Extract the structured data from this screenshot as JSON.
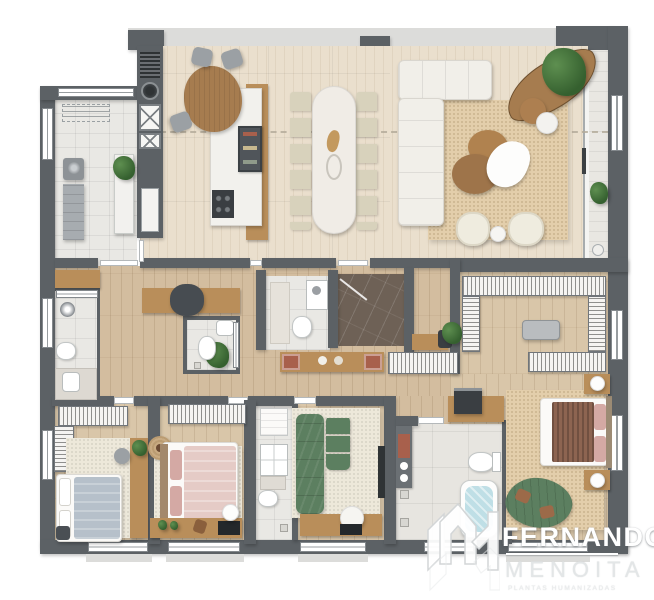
{
  "page": {
    "type": "residential floor plan — humanized top-view render",
    "background": "#ffffff"
  },
  "brand": {
    "line1": "FERNANDO",
    "line2": "MENOITA",
    "tagline": "PLANTAS HUMANIZADAS",
    "monogram": "FM-chevron-monogram"
  },
  "colors": {
    "wall": "#5c6165",
    "slab": "#dcdcda",
    "socialFloor": "#eadfcd",
    "serviceFloor": "#eae6dc",
    "hallFloor": "#d3bd9f",
    "bedroomFloor": "#d9c6a9",
    "tile": "#e9e8e4",
    "tileBig": "#e7e5e0",
    "marbleDark": "#6e6156",
    "marbleWhite": "#f2f1ed",
    "balconyFloor": "#e9e7e2",
    "rugBeige": "#e3ceab",
    "rugCream": "#ede8da",
    "woodFurn": "#b98e5a",
    "sofaWhite": "#f1efe9",
    "sofaGreen": "#5c7f60",
    "chaiseBrown": "#a67c4f",
    "bedGray": "#b6c0ca",
    "bedPink": "#e5cbc6",
    "duvetBrown": "#8d6451",
    "pillowPink": "#d4a9a4",
    "tub": "#bfdfe6",
    "terracotta": "#a8604c",
    "plantGreen": "#35602f",
    "darkAppliance": "#3a3e42",
    "logoWhite": "#ffffff",
    "logoLight": "#e3e6e7"
  },
  "rooms": [
    {
      "id": "service-laundry",
      "furniture": [
        "drying-rack",
        "washing-machine",
        "tall-appliance",
        "plant-console"
      ]
    },
    {
      "id": "elevator-core",
      "furniture": [
        "louver-vent",
        "gauge",
        "elevator-1",
        "elevator-2",
        "tall-cabinet"
      ]
    },
    {
      "id": "kitchen",
      "furniture": [
        "breakfast-table",
        "three-chairs",
        "marble-island",
        "wood-bar",
        "cooktop",
        "dark-shelf"
      ]
    },
    {
      "id": "dining-room",
      "furniture": [
        "long-table",
        "twelve-chairs",
        "centerpiece"
      ]
    },
    {
      "id": "living-room",
      "furniture": [
        "l-sofa",
        "curved-brown-chaise",
        "plant",
        "round-coffee-tables",
        "white-throw",
        "two-armchairs",
        "side-table",
        "beige-rug"
      ]
    },
    {
      "id": "balcony",
      "furniture": [
        "plants",
        "glass-door"
      ]
    },
    {
      "id": "guest-bathroom",
      "furniture": [
        "shower",
        "toilet",
        "vanity",
        "overhead-cabinet"
      ]
    },
    {
      "id": "home-office-nook",
      "furniture": [
        "desk",
        "chair",
        "floor-plant"
      ]
    },
    {
      "id": "powder-room",
      "furniture": [
        "toilet",
        "sink",
        "towel-rail"
      ]
    },
    {
      "id": "hall-bathroom",
      "furniture": [
        "counter",
        "toilet",
        "shower"
      ]
    },
    {
      "id": "private-elevator-hall",
      "furniture": [
        "dark-marble-floor",
        "entry-door"
      ]
    },
    {
      "id": "hallway",
      "furniture": [
        "console-terracotta-decor",
        "wardrobe",
        "wood-shelf",
        "plant-pot"
      ]
    },
    {
      "id": "walk-in-closet",
      "furniture": [
        "u-shaped-wardrobes",
        "island-bench",
        "coffee-counter",
        "coffee-machine"
      ]
    },
    {
      "id": "bedroom-1",
      "furniture": [
        "gray-bed",
        "l-wardrobe",
        "side-desk",
        "stool",
        "cream-rug"
      ]
    },
    {
      "id": "bedroom-2",
      "furniture": [
        "pink-bed",
        "wardrobe",
        "desk-with-tv",
        "dome-lamp",
        "round-jute-rug",
        "cream-rug"
      ]
    },
    {
      "id": "service-bathroom",
      "furniture": [
        "cabinet",
        "washer",
        "counter",
        "toilet",
        "shower-drain"
      ]
    },
    {
      "id": "tv-room",
      "furniture": [
        "green-sectional",
        "green-ottomans",
        "media-console",
        "pouf",
        "wall-tv",
        "cream-rug"
      ]
    },
    {
      "id": "master-bathroom",
      "furniture": [
        "vanity",
        "terracotta-tray",
        "toilet",
        "bathtub",
        "floor-drains"
      ]
    },
    {
      "id": "master-bedroom",
      "furniture": [
        "king-bed",
        "brown-striped-duvet",
        "pink-pillows",
        "two-nightstands",
        "round-lamps",
        "curved-green-sofa",
        "beige-rug"
      ]
    }
  ]
}
